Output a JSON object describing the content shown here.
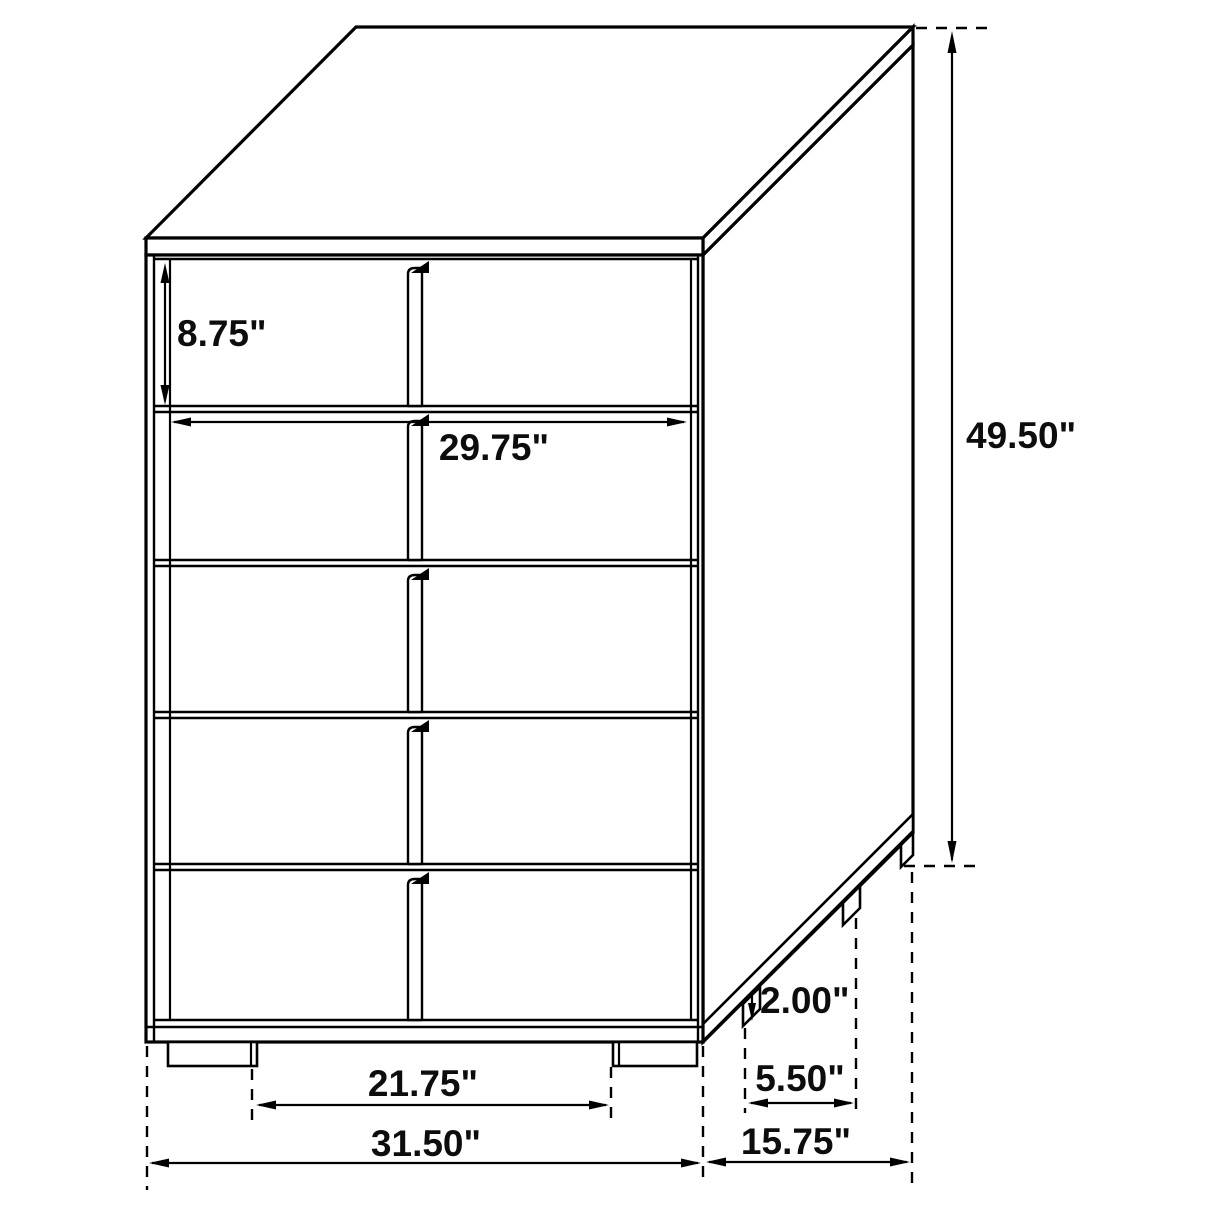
{
  "figure": {
    "background": "#ffffff",
    "line_color": "#000000",
    "label_color": "#0d0d0d",
    "subject": "5-drawer chest dimension diagram"
  },
  "dimensions": {
    "top_drawer_height": "8.75\"",
    "drawer_width": "29.75\"",
    "overall_height": "49.50\"",
    "leg_height": "2.00\"",
    "side_leg_spacing": "5.50\"",
    "front_leg_spacing": "21.75\"",
    "overall_width": "31.50\"",
    "overall_depth": "15.75\""
  }
}
